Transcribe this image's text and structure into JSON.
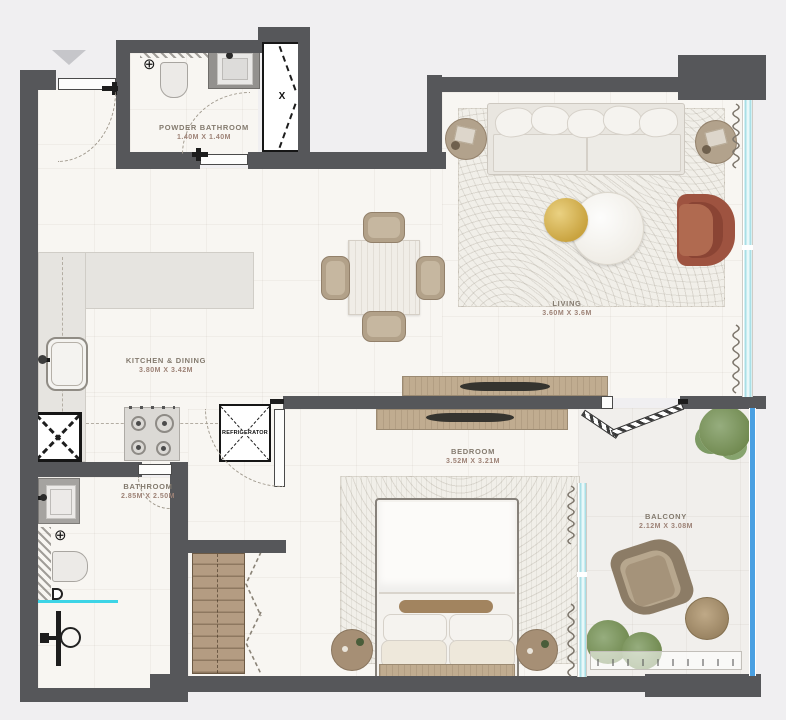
{
  "floorplan": {
    "rooms": [
      {
        "name": "POWDER BATHROOM",
        "dims": "1.40M X 1.40M"
      },
      {
        "name": "LIVING",
        "dims": "3.60M X 3.6M"
      },
      {
        "name": "KITCHEN & DINING",
        "dims": "3.80M X 3.42M"
      },
      {
        "name": "BEDROOM",
        "dims": "3.52M X 3.21M"
      },
      {
        "name": "BATHROOM",
        "dims": "2.85M X 2.50M"
      },
      {
        "name": "BALCONY",
        "dims": "2.12M X 3.08M"
      }
    ],
    "refrigerator_label": "REFRIGERATOR",
    "shaft_marker": "X",
    "colors": {
      "wall": "#56575a",
      "floor": "#f8f6f2",
      "window_glass": "#a9dfe6",
      "shower_glass": "#3dd4e6",
      "balcony_glass": "#4aa0e2",
      "terracotta_chair": "#a2543e",
      "gold_table": "#d1ab53",
      "wood": "#c0ac90",
      "plant_green": "#7d9a64"
    }
  }
}
